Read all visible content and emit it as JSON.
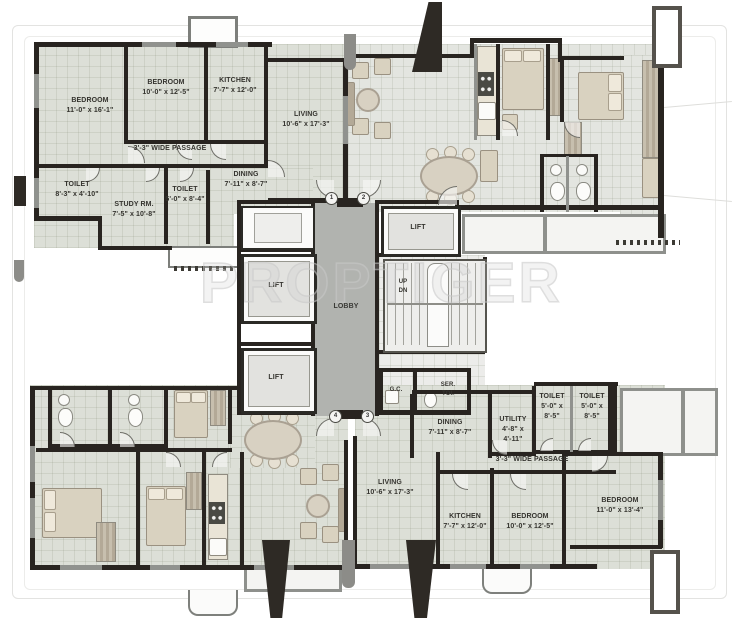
{
  "watermark": "PROPTIGER",
  "palette": {
    "wall": "#282420",
    "window_wall": "#90928e",
    "floor": "#dcdfd7",
    "lobby": "#b1b3af",
    "furniture": "#d9d2c0",
    "watermark_gray": "#c9c9c9"
  },
  "core": {
    "lobby_label": "LOBBY",
    "lifts": [
      "LIFT",
      "LIFT",
      "LIFT"
    ],
    "stairs_up": "UP",
    "stairs_dn": "DN",
    "garbage_chute": "G.C.",
    "service_toilet_line1": "SER.",
    "service_toilet_line2": "TOI.",
    "door1": "1",
    "door2": "2",
    "door3": "3",
    "door4": "4"
  },
  "flat_top_left": {
    "bedroom1": {
      "name": "BEDROOM",
      "dim": "11'-0\" x 16'-1\""
    },
    "bedroom2": {
      "name": "BEDROOM",
      "dim": "10'-0\" x 12'-5\""
    },
    "kitchen": {
      "name": "KITCHEN",
      "dim": "7'-7\" x 12'-0\""
    },
    "living": {
      "name": "LIVING",
      "dim": "10'-6\" x 17'-3\""
    },
    "dining": {
      "name": "DINING",
      "dim": "7'-11\" x 8'-7\""
    },
    "passage": {
      "name": "3'-3\" WIDE PASSAGE"
    },
    "toilet1": {
      "name": "TOILET",
      "dim": "8'-3\" x 4'-10\""
    },
    "study": {
      "name": "STUDY RM.",
      "dim": "7'-5\" x 10'-8\""
    },
    "toilet2": {
      "name": "TOILET",
      "dim": "5'-0\" x 8'-4\""
    }
  },
  "flat_bottom_right": {
    "dining": {
      "name": "DINING",
      "dim": "7'-11\" x 8'-7\""
    },
    "utility": {
      "name": "UTILITY",
      "dim": "4'-8\" x 4'-11\""
    },
    "toilet1": {
      "name": "TOILET",
      "dim": "5'-0\" x 8'-5\""
    },
    "toilet2": {
      "name": "TOILET",
      "dim": "5'-0\" x 8'-5\""
    },
    "passage": {
      "name": "3'-3\" WIDE PASSAGE"
    },
    "living": {
      "name": "LIVING",
      "dim": "10'-6\" x 17'-3\""
    },
    "kitchen": {
      "name": "KITCHEN",
      "dim": "7'-7\" x 12'-0\""
    },
    "bedroom1": {
      "name": "BEDROOM",
      "dim": "10'-0\" x 12'-5\""
    },
    "bedroom2": {
      "name": "BEDROOM",
      "dim": "11'-0\" x 13'-4\""
    }
  }
}
